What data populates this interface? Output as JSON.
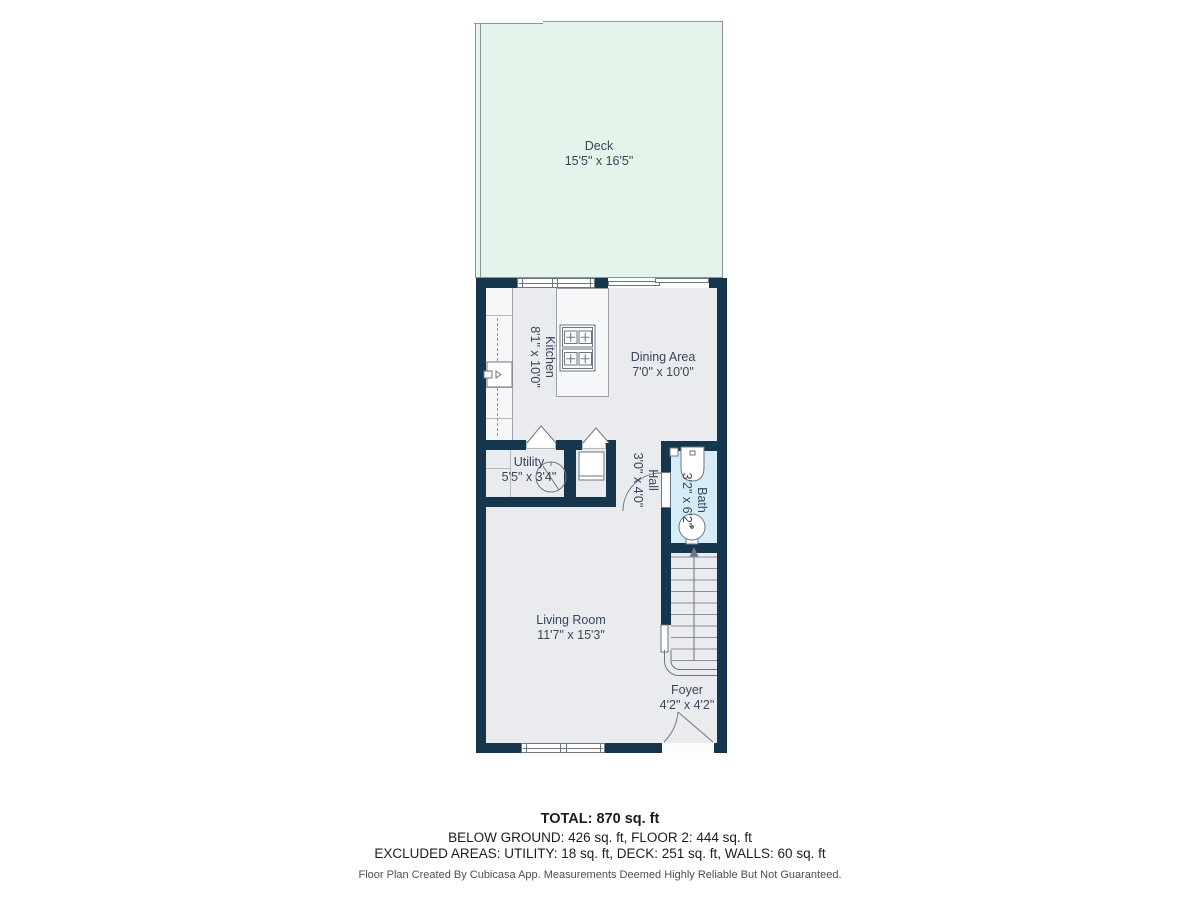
{
  "colors": {
    "wall": "#16364d",
    "floor": "#eaebee",
    "deck": "#e4f4ea",
    "bath": "#d6ecf7",
    "label": "#37475a",
    "line": "#6d7681"
  },
  "rooms": {
    "deck": {
      "name": "Deck",
      "dims": "15'5\" x 16'5\""
    },
    "kitchen": {
      "name": "Kitchen",
      "dims": "8'1\" x 10'0\""
    },
    "dining": {
      "name": "Dining Area",
      "dims": "7'0\" x 10'0\""
    },
    "utility": {
      "name": "Utility",
      "dims": "5'5\" x 3'4\""
    },
    "hall": {
      "name": "Hall",
      "dims": "3'0\" x 4'0\""
    },
    "bath": {
      "name": "Bath",
      "dims": "3'2\" x 6'2\""
    },
    "living": {
      "name": "Living Room",
      "dims": "11'7\" x 15'3\""
    },
    "foyer": {
      "name": "Foyer",
      "dims": "4'2\" x 4'2\""
    }
  },
  "summary": {
    "total": "TOTAL: 870 sq. ft",
    "floors": "BELOW GROUND: 426 sq. ft, FLOOR 2: 444 sq. ft",
    "excluded": "EXCLUDED AREAS: UTILITY: 18 sq. ft, DECK: 251 sq. ft, WALLS: 60 sq. ft",
    "disclaimer": "Floor Plan Created By Cubicasa App. Measurements Deemed Highly Reliable But Not Guaranteed."
  }
}
